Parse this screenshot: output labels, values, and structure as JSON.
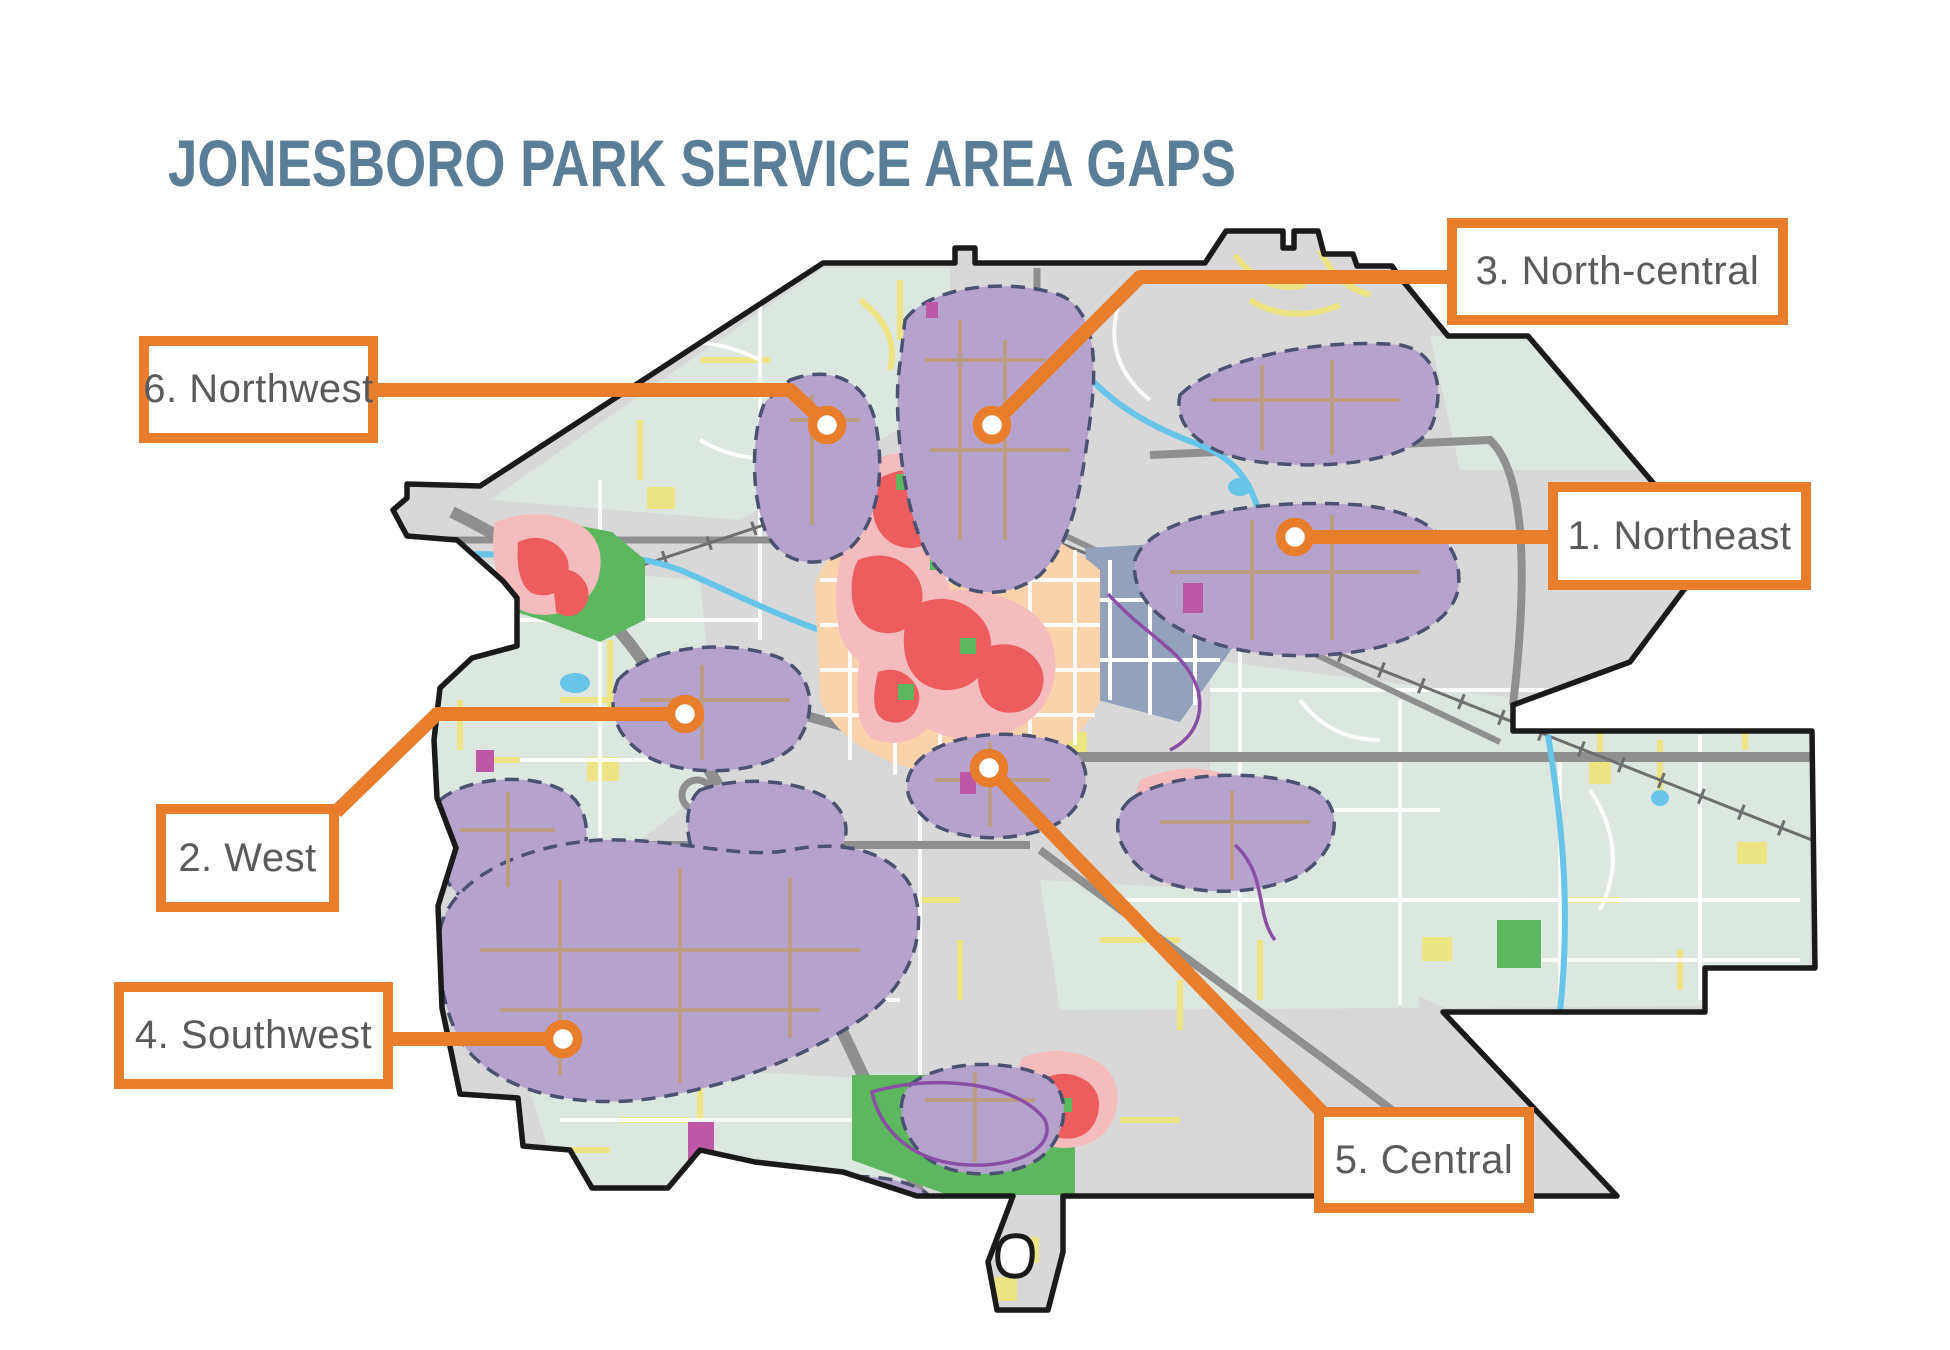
{
  "title": {
    "text": "JONESBORO PARK SERVICE AREA GAPS"
  },
  "colors": {
    "accent_orange": "#E87D2B",
    "title_blue": "#5A7E97",
    "label_gray": "#595A5C",
    "base_gray": "#D8D8D8",
    "sage_green": "#DCE7E0",
    "gap_purple": "#B6A3CD",
    "gap_border_navy": "#4B5170",
    "gap_road_tan": "#BD9C83",
    "heat_red": "#ED5C5E",
    "heat_pink": "#F5BCBD",
    "heat_peach": "#F9D3AB",
    "park_green": "#5CB75F",
    "water_blue": "#66C5E9",
    "campus_bluegray": "#93A1BD",
    "street_yellow": "#EDE583",
    "trail_magenta": "#BD58A7",
    "highway_gray": "#8F8F8F",
    "boundary_black": "#1A1A1A"
  },
  "callouts": [
    {
      "id": "northeast",
      "label": "1. Northeast",
      "box": {
        "x": 1548,
        "y": 482,
        "w": 263,
        "h": 108
      },
      "marker": {
        "x": 1295,
        "y": 537
      },
      "leader": "1305,537 1548,537"
    },
    {
      "id": "west",
      "label": "2. West",
      "box": {
        "x": 156,
        "y": 804,
        "w": 183,
        "h": 108
      },
      "marker": {
        "x": 685,
        "y": 714
      },
      "leader": "685,714 437,714 336,812"
    },
    {
      "id": "north-central",
      "label": "3. North-central",
      "box": {
        "x": 1447,
        "y": 218,
        "w": 341,
        "h": 107
      },
      "marker": {
        "x": 992,
        "y": 425
      },
      "leader": "998,419 1140,277 1447,277"
    },
    {
      "id": "southwest",
      "label": "4. Southwest",
      "box": {
        "x": 114,
        "y": 982,
        "w": 279,
        "h": 107
      },
      "marker": {
        "x": 563,
        "y": 1039
      },
      "leader": "550,1039 393,1039"
    },
    {
      "id": "central",
      "label": "5. Central",
      "box": {
        "x": 1314,
        "y": 1107,
        "w": 220,
        "h": 106
      },
      "marker": {
        "x": 989,
        "y": 768
      },
      "leader": "996,775 1322,1112"
    },
    {
      "id": "northwest",
      "label": "6. Northwest",
      "box": {
        "x": 139,
        "y": 336,
        "w": 239,
        "h": 107
      },
      "marker": {
        "x": 827,
        "y": 425
      },
      "leader": "377,390 790,390 827,425"
    }
  ]
}
